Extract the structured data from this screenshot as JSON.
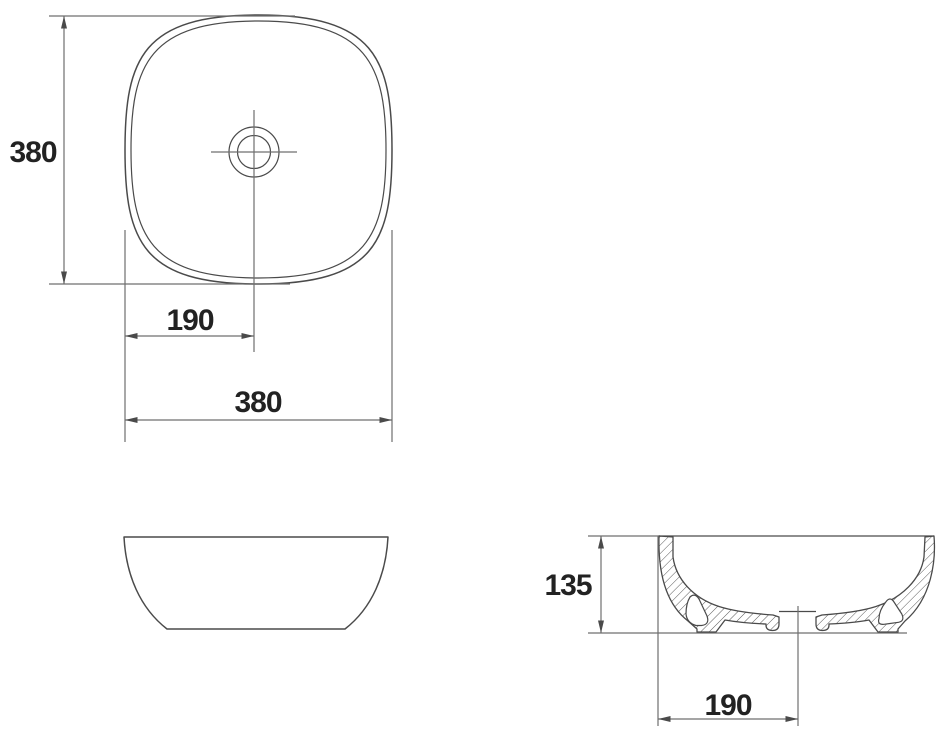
{
  "drawing": {
    "type": "technical-dimension-drawing",
    "subject": "square countertop washbasin",
    "units_implied": "mm",
    "views": {
      "top_view": {
        "description": "plan view of rounded-square basin with central drain",
        "dim_height_label": "380",
        "dim_center_offset_label": "190",
        "dim_width_label": "380"
      },
      "front_view": {
        "description": "front elevation of bowl silhouette"
      },
      "section_view": {
        "description": "cross-section with hatched wall, feet cavities and drain recess",
        "dim_height_label": "135",
        "dim_center_offset_label": "190"
      }
    },
    "colors": {
      "line": "#4a4a4a",
      "dim": "#6f6f6f",
      "text": "#222222",
      "background": "#ffffff"
    }
  }
}
